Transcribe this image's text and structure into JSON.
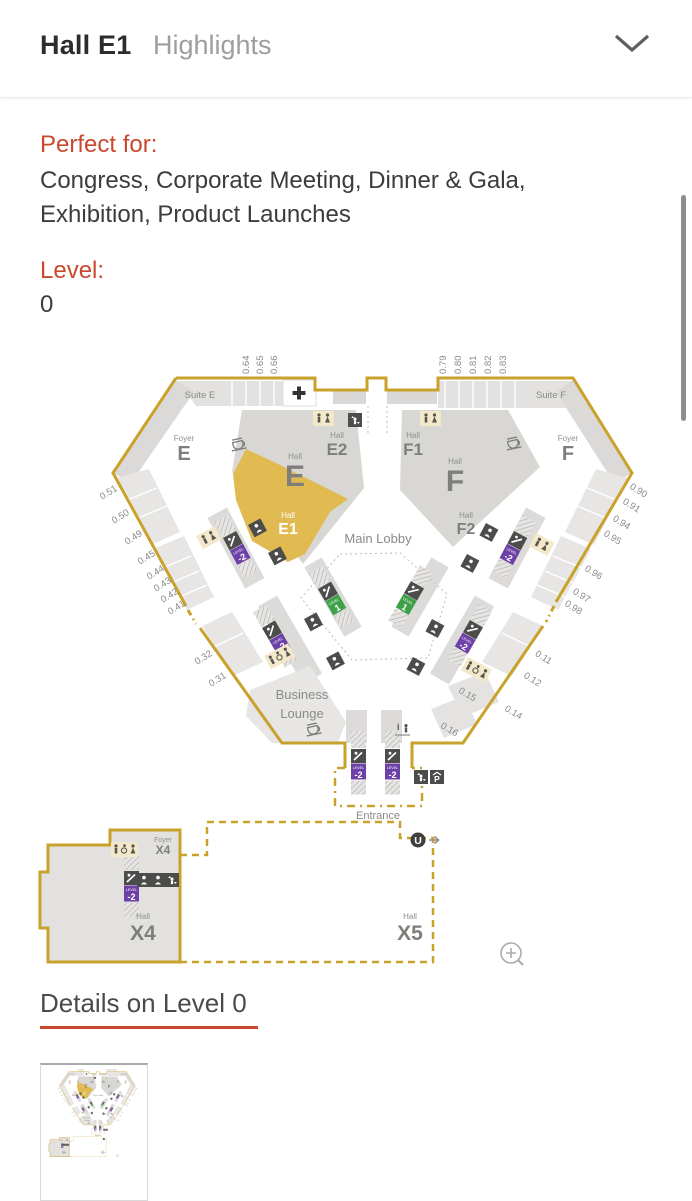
{
  "header": {
    "title": "Hall E1",
    "subtitle": "Highlights"
  },
  "info": {
    "perfect_for_label": "Perfect for:",
    "perfect_for_line1": "Congress, Corporate Meeting, Dinner & Gala,",
    "perfect_for_line2": "Exhibition, Product Launches",
    "level_label": "Level:",
    "level_value": "0"
  },
  "details": {
    "heading": "Details on Level 0"
  },
  "map": {
    "halls": {
      "suite_e": "Suite E",
      "suite_f": "Suite F",
      "foyer_label": "Foyer",
      "hall_label": "Hall",
      "foyer_e": "E",
      "foyer_f": "F",
      "e": "E",
      "e1": "E1",
      "e2": "E2",
      "f": "F",
      "f1": "F1",
      "f2": "F2",
      "x4": "X4",
      "x5": "X5",
      "main_lobby": "Main Lobby",
      "business_lounge_line1": "Business",
      "business_lounge_line2": "Lounge",
      "entrance": "Entrance"
    },
    "rooms": {
      "top_left": [
        "0.64",
        "0.65",
        "0.66"
      ],
      "top_right": [
        "0.79",
        "0.80",
        "0.81",
        "0.82",
        "0.83"
      ],
      "left": [
        "0.51",
        "0.50",
        "0.49",
        "0.45",
        "0.44",
        "0.43",
        "0.42",
        "0.41"
      ],
      "left_lower": [
        "0.32",
        "0.31"
      ],
      "right": [
        "0.90",
        "0.91",
        "0.94",
        "0.95",
        "0.96",
        "0.97",
        "0.98"
      ],
      "right_lower": [
        "0.11",
        "0.12"
      ],
      "bottom_right": [
        "0.15",
        "0.16",
        "0.14"
      ]
    },
    "badges": {
      "level_word": "LEVEL",
      "down": "-2",
      "up": "1",
      "parking": "P",
      "ubahn": "U"
    },
    "colors": {
      "gold": "#C9A22B",
      "e1_fill": "#E2BA52",
      "purple": "#6C40A6",
      "green": "#3FA04A",
      "accent_red": "#C9492E"
    }
  }
}
